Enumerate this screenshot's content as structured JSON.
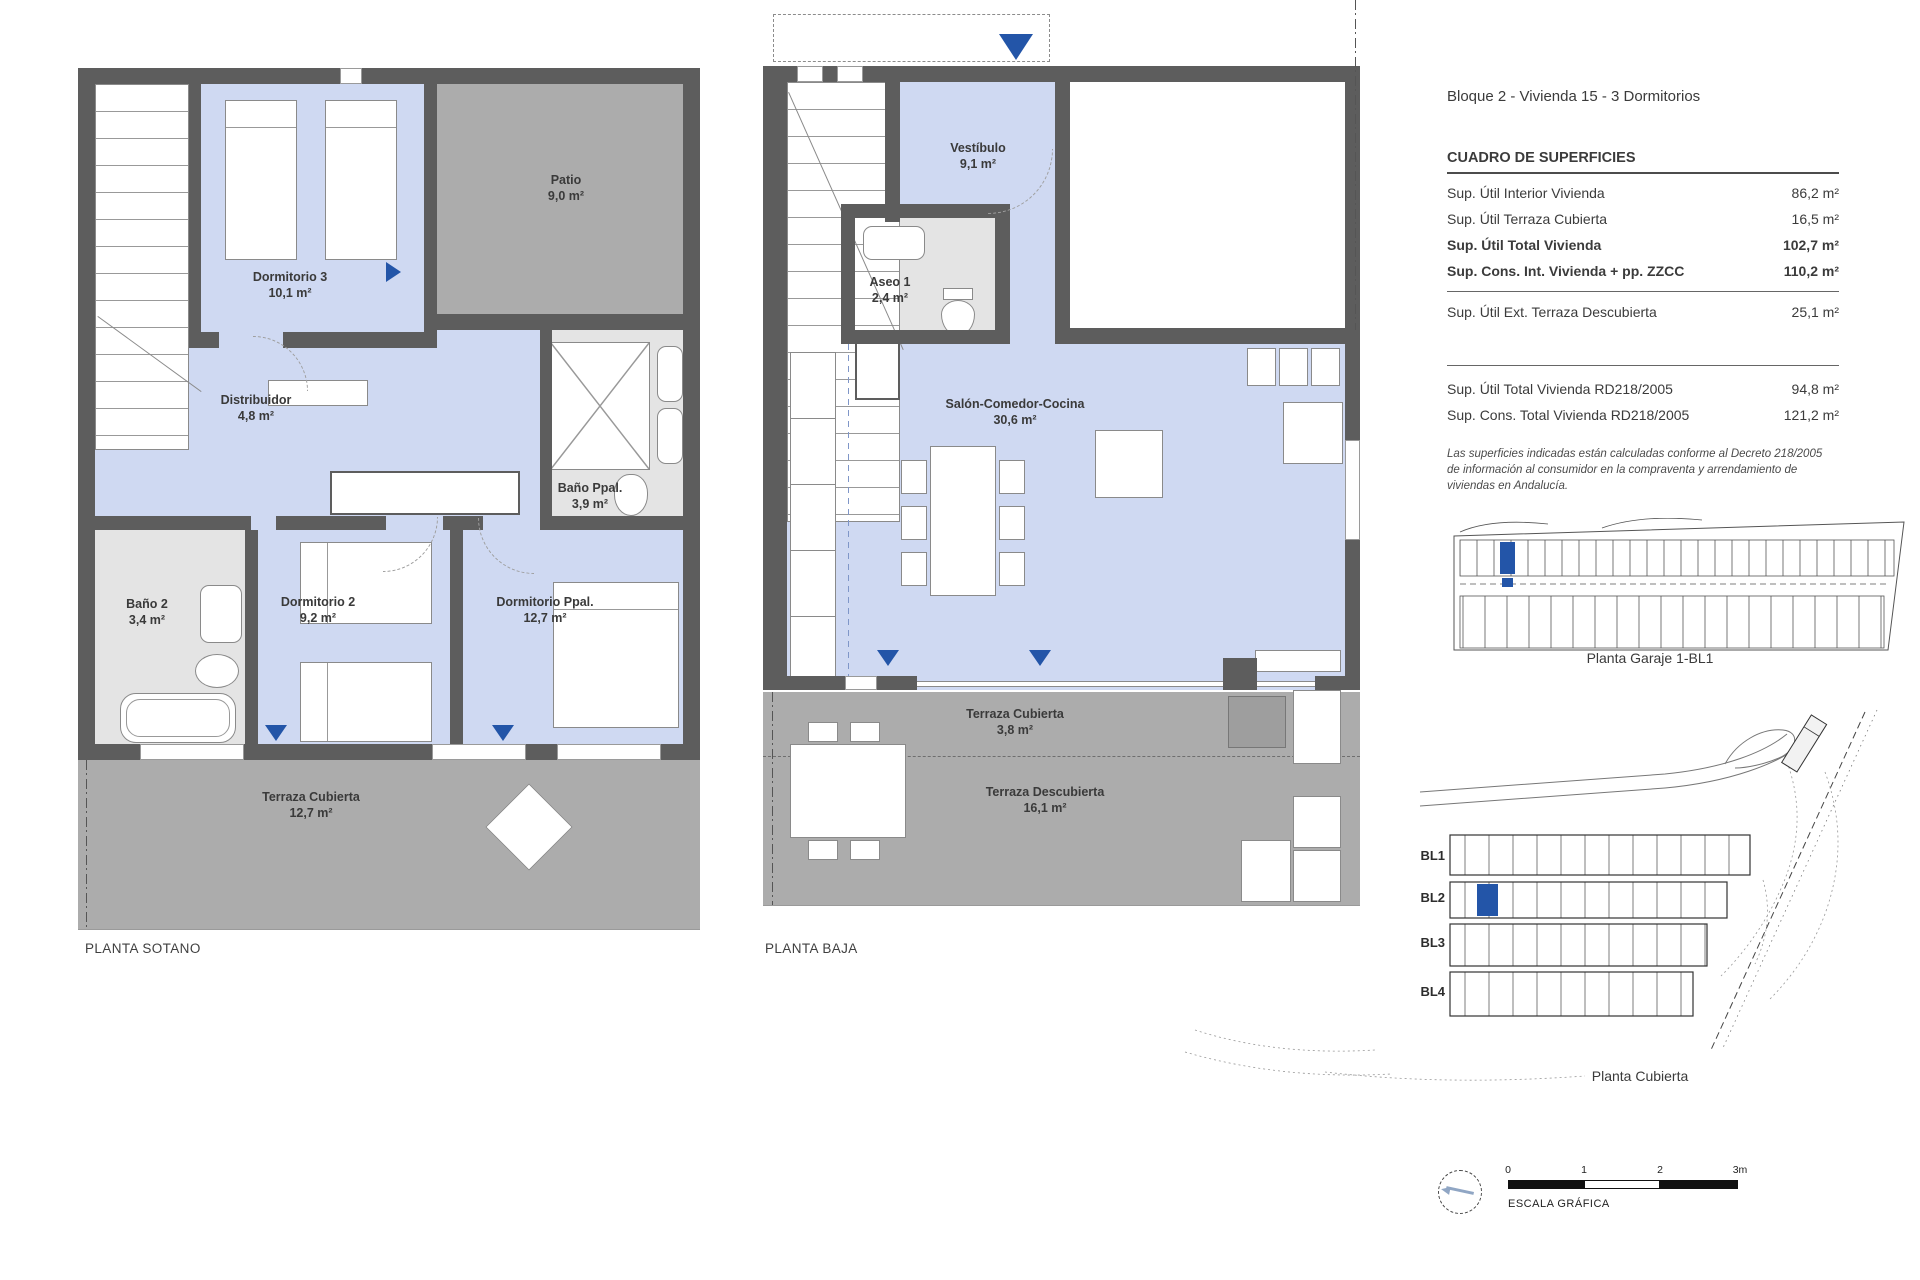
{
  "header": {
    "title": "Bloque 2 - Vivienda 15 - 3 Dormitorios"
  },
  "surfaces": {
    "title": "CUADRO DE SUPERFICIES",
    "rows": [
      {
        "label": "Sup. Útil Interior Vivienda",
        "value": "86,2 m²"
      },
      {
        "label": "Sup. Útil Terraza Cubierta",
        "value": "16,5 m²"
      },
      {
        "label": "Sup. Útil Total Vivienda",
        "value": "102,7 m²"
      },
      {
        "label": "Sup. Cons. Int. Vivienda + pp. ZZCC",
        "value": "110,2 m²"
      },
      {
        "label": "Sup. Útil Ext. Terraza Descubierta",
        "value": "25,1 m²"
      },
      {
        "label": "Sup. Útil Total Vivienda RD218/2005",
        "value": "94,8 m²"
      },
      {
        "label": "Sup. Cons. Total Vivienda RD218/2005",
        "value": "121,2 m²"
      }
    ],
    "disclaimer": "Las superficies indicadas están calculadas conforme al Decreto 218/2005 de información al consumidor en la compraventa y arrendamiento de viviendas en Andalucía."
  },
  "plans": {
    "sotano": {
      "caption": "PLANTA SOTANO",
      "rooms": {
        "dormitorio3": {
          "name": "Dormitorio 3",
          "area": "10,1 m²"
        },
        "patio": {
          "name": "Patio",
          "area": "9,0 m²"
        },
        "distribuidor": {
          "name": "Distribuidor",
          "area": "4,8 m²"
        },
        "bano_ppal": {
          "name": "Baño Ppal.",
          "area": "3,9 m²"
        },
        "bano2": {
          "name": "Baño 2",
          "area": "3,4 m²"
        },
        "dormitorio2": {
          "name": "Dormitorio 2",
          "area": "9,2 m²"
        },
        "dormitorio_ppal": {
          "name": "Dormitorio Ppal.",
          "area": "12,7 m²"
        },
        "terraza_cubierta": {
          "name": "Terraza Cubierta",
          "area": "12,7 m²"
        }
      }
    },
    "baja": {
      "caption": "PLANTA BAJA",
      "rooms": {
        "vestibulo": {
          "name": "Vestíbulo",
          "area": "9,1 m²"
        },
        "aseo1": {
          "name": "Aseo 1",
          "area": "2,4 m²"
        },
        "salon": {
          "name": "Salón-Comedor-Cocina",
          "area": "30,6 m²"
        },
        "terraza_cubierta": {
          "name": "Terraza Cubierta",
          "area": "3,8 m²"
        },
        "terraza_descubierta": {
          "name": "Terraza Descubierta",
          "area": "16,1 m²"
        }
      }
    }
  },
  "side": {
    "garage_caption": "Planta Garaje 1-BL1",
    "site_caption": "Planta Cubierta",
    "blocks": [
      "BL1",
      "BL2",
      "BL3",
      "BL4"
    ],
    "scale": {
      "ticks": [
        "0",
        "1",
        "2",
        "3m"
      ],
      "label": "ESCALA GRÁFICA"
    }
  },
  "colors": {
    "accent_blue": "#2355a8",
    "room_fill": "#cfd9f2",
    "outdoor_fill": "#acacac",
    "bath_fill": "#e4e4e4",
    "wall": "#5d5d5d"
  }
}
